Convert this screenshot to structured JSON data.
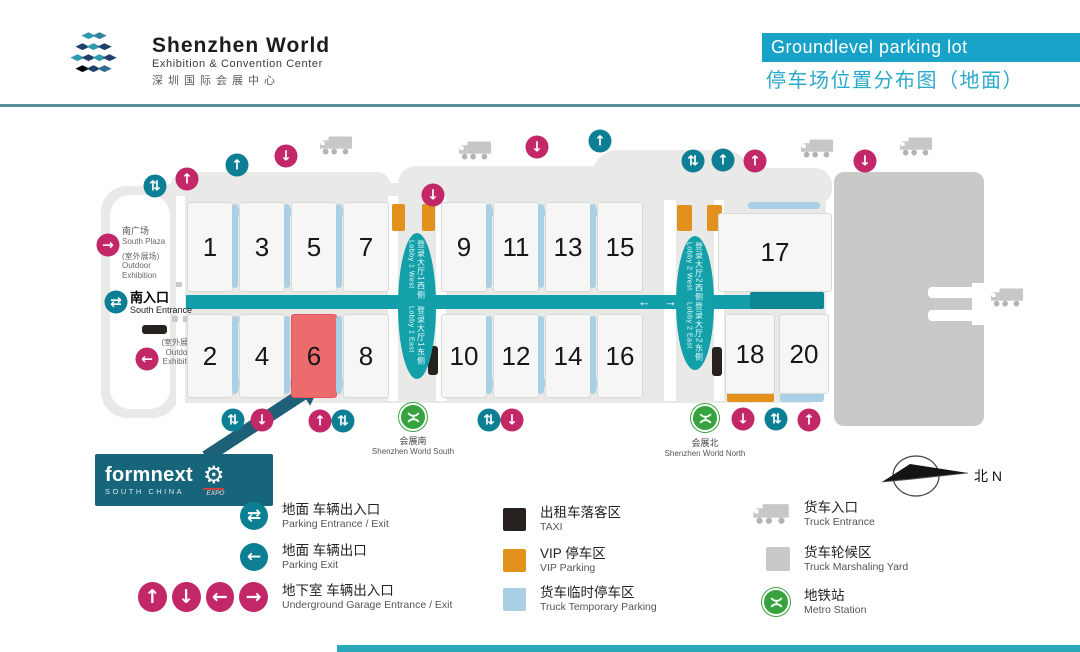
{
  "header": {
    "title": "Shenzhen World",
    "subtitle": "Exhibition & Convention Center",
    "subtitle_cn": "深圳国际会展中心",
    "banner_en": "Groundlevel parking lot",
    "banner_cn": "停车场位置分布图（地面）"
  },
  "map": {
    "hall_groups": {
      "top_a": [
        "1",
        "3",
        "5",
        "7"
      ],
      "top_b": [
        "9",
        "11",
        "13",
        "15"
      ],
      "bottom_a": [
        "2",
        "4",
        "6",
        "8"
      ],
      "bottom_b": [
        "10",
        "12",
        "14",
        "16"
      ],
      "right_top": [
        "17"
      ],
      "right_bottom": [
        "18",
        "20"
      ]
    },
    "highlighted_hall": "6",
    "lobby1": {
      "west_cn": "登录大厅1西侧",
      "west_en": "Lobby 1 West",
      "east_cn": "登录大厅1东侧",
      "east_en": "Lobby 1 East"
    },
    "lobby2": {
      "west_cn": "登录大厅2西侧",
      "west_en": "Lobby 2 West",
      "east_cn": "登录大厅2东侧",
      "east_en": "Lobby 2 East"
    },
    "labels": {
      "south_plaza_cn": "南广场",
      "south_plaza_en": "South Plaza",
      "outdoor_cn": "(室外展场)",
      "outdoor_en1": "Outdoor",
      "outdoor_en2": "Exhibition",
      "south_entrance_cn": "南入口",
      "south_entrance_en": "South Entrance",
      "outdoor2_cn": "(室外展场)",
      "outdoor2_en1": "Outdoor",
      "outdoor2_en2": "Exhibition",
      "metro_south_cn": "会展南",
      "metro_south_en": "Shenzhen World South",
      "metro_north_cn": "会展北",
      "metro_north_en": "Shenzhen World North",
      "compass": "北 N"
    },
    "corridor_arrows": {
      "left": "←",
      "right": "→"
    },
    "icons": [
      {
        "n": "parking-entrance-exit-icon",
        "t": "teal",
        "g": "⇅",
        "x": 155,
        "y": 186
      },
      {
        "n": "underground-garage-entrance-icon",
        "t": "pink",
        "g": "↑",
        "x": 187,
        "y": 179
      },
      {
        "n": "parking-entrance-icon",
        "t": "teal",
        "g": "↑",
        "x": 237,
        "y": 165
      },
      {
        "n": "underground-garage-exit-icon",
        "t": "pink",
        "g": "↓",
        "x": 286,
        "y": 156
      },
      {
        "n": "truck-entrance-icon",
        "t": "truck",
        "x": 336,
        "y": 148
      },
      {
        "n": "underground-garage-exit-icon",
        "t": "pink",
        "g": "↓",
        "x": 433,
        "y": 195
      },
      {
        "n": "truck-entrance-icon",
        "t": "truck",
        "x": 475,
        "y": 153
      },
      {
        "n": "underground-garage-exit-icon",
        "t": "pink",
        "g": "↓",
        "x": 537,
        "y": 147
      },
      {
        "n": "parking-entrance-icon",
        "t": "teal",
        "g": "↑",
        "x": 600,
        "y": 141
      },
      {
        "n": "parking-entrance-exit-icon",
        "t": "teal",
        "g": "⇅",
        "x": 693,
        "y": 161
      },
      {
        "n": "parking-entrance-icon",
        "t": "teal",
        "g": "↑",
        "x": 723,
        "y": 160
      },
      {
        "n": "underground-garage-entrance-icon",
        "t": "pink",
        "g": "↑",
        "x": 755,
        "y": 161
      },
      {
        "n": "truck-entrance-icon",
        "t": "truck",
        "x": 817,
        "y": 151
      },
      {
        "n": "underground-garage-exit-icon",
        "t": "pink",
        "g": "↓",
        "x": 865,
        "y": 161
      },
      {
        "n": "truck-entrance-icon",
        "t": "truck",
        "x": 916,
        "y": 149
      },
      {
        "n": "truck-entrance-icon",
        "t": "truck",
        "x": 1007,
        "y": 300
      },
      {
        "n": "underground-garage-entrance-icon",
        "t": "pink",
        "g": "→",
        "x": 108,
        "y": 245
      },
      {
        "n": "parking-entrance-exit-icon",
        "t": "teal",
        "g": "⇄",
        "x": 116,
        "y": 302
      },
      {
        "n": "underground-garage-exit-icon",
        "t": "pink",
        "g": "←",
        "x": 147,
        "y": 359
      },
      {
        "n": "parking-entrance-exit-icon",
        "t": "teal",
        "g": "⇅",
        "x": 233,
        "y": 420
      },
      {
        "n": "underground-garage-exit-icon",
        "t": "pink",
        "g": "↓",
        "x": 262,
        "y": 420
      },
      {
        "n": "underground-garage-entrance-icon",
        "t": "pink",
        "g": "↑",
        "x": 320,
        "y": 421
      },
      {
        "n": "parking-entrance-exit-icon",
        "t": "teal",
        "g": "⇅",
        "x": 343,
        "y": 421
      },
      {
        "n": "metro-station-icon",
        "t": "metro",
        "x": 413,
        "y": 417
      },
      {
        "n": "parking-entrance-exit-icon",
        "t": "teal",
        "g": "⇅",
        "x": 489,
        "y": 420
      },
      {
        "n": "underground-garage-exit-icon",
        "t": "pink",
        "g": "↓",
        "x": 512,
        "y": 420
      },
      {
        "n": "metro-station-icon",
        "t": "metro",
        "x": 705,
        "y": 418
      },
      {
        "n": "underground-garage-exit-icon",
        "t": "pink",
        "g": "↓",
        "x": 743,
        "y": 419
      },
      {
        "n": "parking-entrance-exit-icon",
        "t": "teal",
        "g": "⇅",
        "x": 776,
        "y": 419
      },
      {
        "n": "underground-garage-entrance-icon",
        "t": "pink",
        "g": "↑",
        "x": 809,
        "y": 420
      }
    ]
  },
  "formnext": {
    "name": "formnext",
    "region": "SOUTH CHINA",
    "expo": "EXPO"
  },
  "legend": {
    "left": [
      {
        "glyph": "⇄",
        "cn": "地面 车辆出入口",
        "en": "Parking Entrance / Exit"
      },
      {
        "glyph": "←",
        "cn": "地面 车辆出口",
        "en": "Parking Exit"
      },
      {
        "glyphs": [
          "↑",
          "↓",
          "←",
          "→"
        ],
        "cn": "地下室 车辆出入口",
        "en": "Underground Garage Entrance / Exit"
      }
    ],
    "mid": [
      {
        "cn": "出租车落客区",
        "en": "TAXI"
      },
      {
        "cn": "VIP 停车区",
        "en": "VIP Parking"
      },
      {
        "cn": "货车临时停车区",
        "en": "Truck Temporary Parking"
      }
    ],
    "right": [
      {
        "cn": "货车入口",
        "en": "Truck Entrance"
      },
      {
        "cn": "货车轮候区",
        "en": "Truck Marshaling Yard"
      },
      {
        "cn": "地铁站",
        "en": "Metro Station"
      }
    ]
  },
  "colors": {
    "accent_cyan": "#18a2c8",
    "teal_icon": "#0d7f95",
    "pink_icon": "#c22767",
    "corridor_teal": "#129fab",
    "orange_vip": "#e2911c",
    "light_blue_truck": "#a9d0e4",
    "taxi_black": "#26211f",
    "metro_green": "#36a33f",
    "hall_highlight_red": "#ec6b6d",
    "yard_gray": "#c9c9c8",
    "formnext_teal": "#17657b"
  }
}
